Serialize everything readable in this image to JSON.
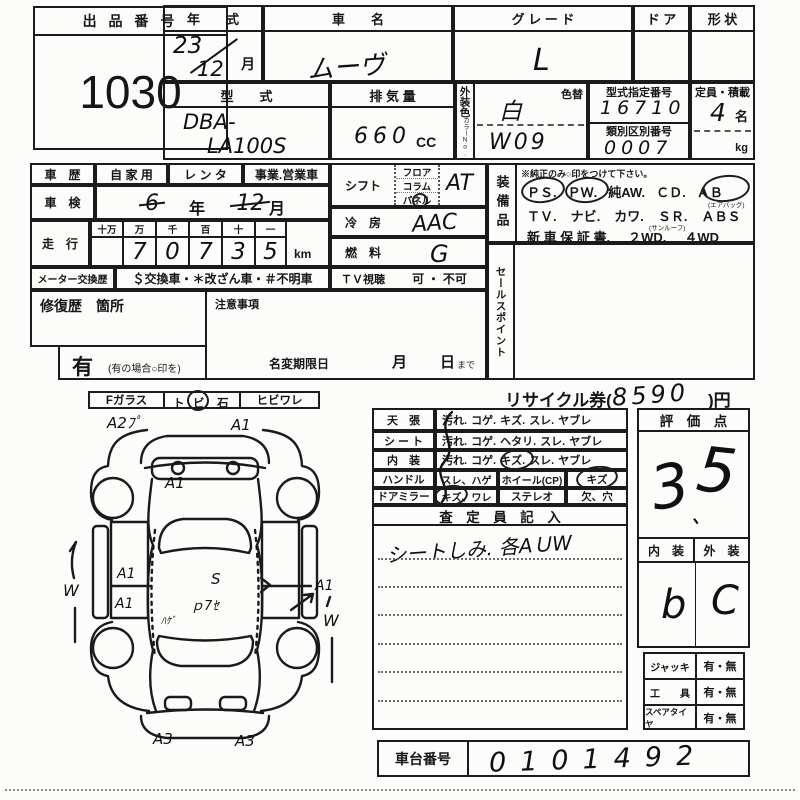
{
  "auction": {
    "label": "出 品 番 号",
    "number": "1030"
  },
  "top": {
    "year_label": "年　　式",
    "year_hw": "23",
    "month_hw": "12",
    "month_unit": "月",
    "name_label": "車　　名",
    "name_hw": "ムーヴ",
    "grade_label": "グ レ ー ド",
    "grade_hw": "L",
    "door_label": "ド ア",
    "shape_label": "形 状",
    "model_label": "型　　式",
    "model_hw1": "DBA-",
    "model_hw2": "LA100S",
    "disp_label": "排 気 量",
    "disp_hw": "660",
    "disp_unit": "CC",
    "color_label": "外装色",
    "color_no_label": "カラーNo.",
    "color_change_label": "色替",
    "color_hw": "白",
    "color_code_hw": "W09",
    "type_no_label": "型式指定番号",
    "type_no_hw": "16710",
    "class_no_label": "類別区別番号",
    "class_no_hw": "0007",
    "capacity_label": "定員・積載",
    "capacity_hw": "4",
    "capacity_unit": "名",
    "weight_unit": "kg"
  },
  "history": {
    "label": "車　歴",
    "opt_private": "自 家 用",
    "opt_rental": "レ ン タ",
    "opt_business": "事業.営業車",
    "shaken_label": "車　検",
    "shaken_year_hw": "6",
    "year_unit": "年",
    "shaken_month_hw": "12",
    "month_unit": "月",
    "mileage_label": "走　行",
    "mileage_cols": [
      "十万",
      "万",
      "千",
      "百",
      "十",
      "一"
    ],
    "mileage_digits": [
      "",
      "7",
      "0",
      "7",
      "3",
      "5"
    ],
    "mileage_unit": "km",
    "meter_label": "メーター交換歴",
    "meter_options": "＄交換車・＊改ざん車・＃不明車"
  },
  "controls": {
    "shift_label": "シフト",
    "shift_opts": [
      "フロア",
      "コラム",
      "パネル"
    ],
    "shift_hw": "AT",
    "ac_label": "冷　房",
    "ac_hw": "AAC",
    "fuel_label": "燃　料",
    "fuel_hw": "G",
    "tv_label": "ＴＶ視聴",
    "tv_options": "可 ・ 不可"
  },
  "equipment": {
    "label": "装備品",
    "note": "※純正のみ○印をつけて下さい。",
    "row1": [
      "ＰＳ.",
      "ＰＷ.",
      "純AW.",
      "ＣＤ.",
      "ＡＢ"
    ],
    "row1_circled": [
      true,
      true,
      false,
      false,
      true
    ],
    "row1_sub": "(エアバッグ)",
    "row2": [
      "ＴＶ.",
      "ナビ.",
      "カワ.",
      "ＳＲ.",
      "ＡＢＳ"
    ],
    "row2_sub": "(サンルーフ)",
    "row3": [
      "新 車 保 証 書.",
      "２WD.",
      "４WD"
    ]
  },
  "sales_point_label": "セールスポイント",
  "repair": {
    "label": "修復歴　箇所",
    "notes_label": "注意事項",
    "has_label": "有",
    "has_note": "(有の場合○印を)",
    "name_change_label": "名変期限日",
    "month_label": "月",
    "day_label": "日",
    "made_label": "まで"
  },
  "glass": {
    "f_label": "Fガラス",
    "stone_t": "ト",
    "stone_bi": "ビ",
    "stone_ishi": "石",
    "crack_label": "ヒビワレ"
  },
  "recycle": {
    "pre": "リサイクル券(",
    "amount_hw": "8590",
    "post": ")円"
  },
  "condition": {
    "rows": [
      {
        "label": "天　張",
        "words": [
          "汚れ.",
          "コゲ.",
          "キズ.",
          "スレ.",
          "ヤブレ"
        ]
      },
      {
        "label": "シ ー ト",
        "words": [
          "汚れ.",
          "コゲ.",
          "ヘタリ.",
          "スレ.",
          "ヤブレ"
        ]
      },
      {
        "label": "内　装",
        "words": [
          "汚れ.",
          "コゲ.",
          "キズ.",
          "スレ.",
          "ヤブレ"
        ]
      }
    ],
    "handle_label": "ハンドル",
    "handle_val": "スレ、ハゲ",
    "wheel_label": "ホイール(CP)",
    "wheel_val": "キズ",
    "mirror_label": "ドアミラー",
    "mirror_val": "キズ、ワレ",
    "stereo_label": "ステレオ",
    "stereo_val": "欠、穴"
  },
  "assessor": {
    "header": "査　定　員　記　入",
    "note_hw": "シートしみ. 各AＵW"
  },
  "score": {
    "header": "評　価　点",
    "digit1_hw": "3",
    "dot_hw": "、",
    "digit2_hw": "5"
  },
  "int_ext": {
    "int_label": "内　装",
    "ext_label": "外　装",
    "int_hw": "b",
    "ext_hw": "C"
  },
  "accessories": [
    {
      "label": "ジャッキ",
      "value": "有・無"
    },
    {
      "label": "工　　具",
      "value": "有・無"
    },
    {
      "label": "スペアタイヤ",
      "value": "有・無"
    }
  ],
  "chassis": {
    "label": "車台番号",
    "number_hw": "0101492"
  },
  "diagram": {
    "annotations": {
      "front_left": "A2ﾌﾟ",
      "front_right": "A1",
      "hood": "A1",
      "left_door_1": "A1",
      "left_door_2": "A1",
      "left_side": "W",
      "roof_1": "S",
      "roof_2": "ｐ7ｾ",
      "roof_3": "ﾊｹﾞ",
      "right_door": "A1",
      "right_side": "W",
      "rear_left": "A3",
      "rear_right": "A3"
    }
  }
}
